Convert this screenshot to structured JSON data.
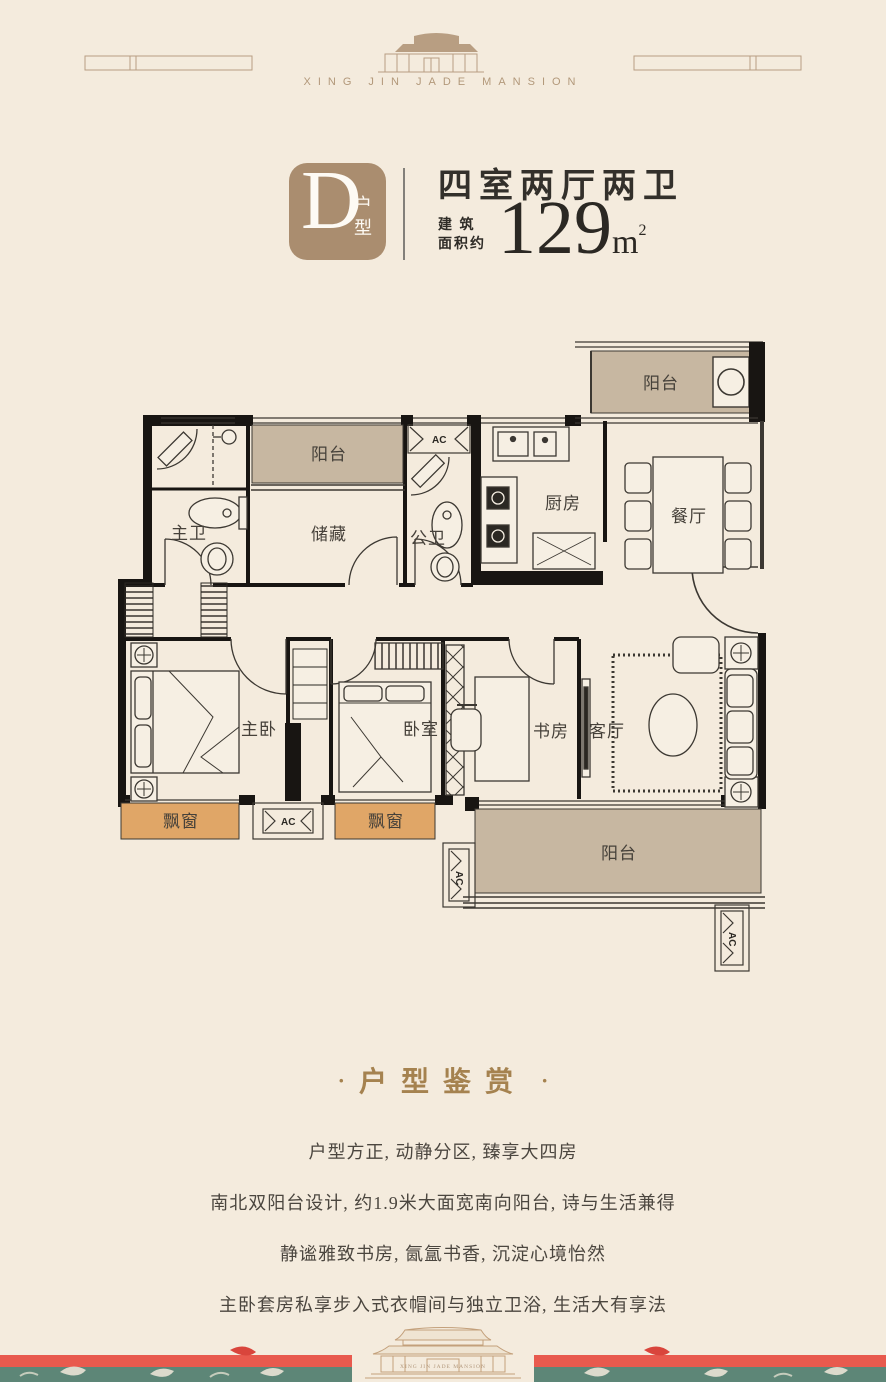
{
  "brand": {
    "name_en": "XING JIN JADE MANSION"
  },
  "unit": {
    "badge_letter": "D",
    "badge_suffix": "户型",
    "rooms_title": "四室两厅两卫",
    "area_prefix_line1": "建 筑",
    "area_prefix_line2": "面积约",
    "area_number": "129",
    "area_unit": "m",
    "area_superscript": "2"
  },
  "floorplan": {
    "labels": {
      "balcony": "阳台",
      "master_bath": "主卫",
      "storage": "储藏",
      "guest_bath": "公卫",
      "kitchen": "厨房",
      "dining": "餐厅",
      "master_bedroom": "主卧",
      "bedroom": "卧室",
      "study": "书房",
      "living_room": "客厅",
      "bay_window": "飘窗",
      "ac": "AC"
    }
  },
  "appreciation": {
    "title": "户型鉴赏",
    "side_dot": "·",
    "lines": [
      "户型方正, 动静分区, 臻享大四房",
      "南北双阳台设计, 约1.9米大面宽南向阳台, 诗与生活兼得",
      "静谧雅致书房, 氤氲书香, 沉淀心境怡然",
      "主卧套房私享步入式衣帽间与独立卫浴, 生活大有享法"
    ]
  },
  "colors": {
    "page_background": "#f4ebdd",
    "badge_tan": "#aa8d6f",
    "gold_accent": "#a5824f",
    "heading_ink": "#33302b",
    "body_text": "#4b463f",
    "balcony_fill": "#c7b7a1",
    "bay_window_fill": "#e0a667",
    "wall_black": "#181512",
    "footer_red": "#e85a4e",
    "footer_green": "#5d8677",
    "ornament_tan": "#b89e82"
  }
}
